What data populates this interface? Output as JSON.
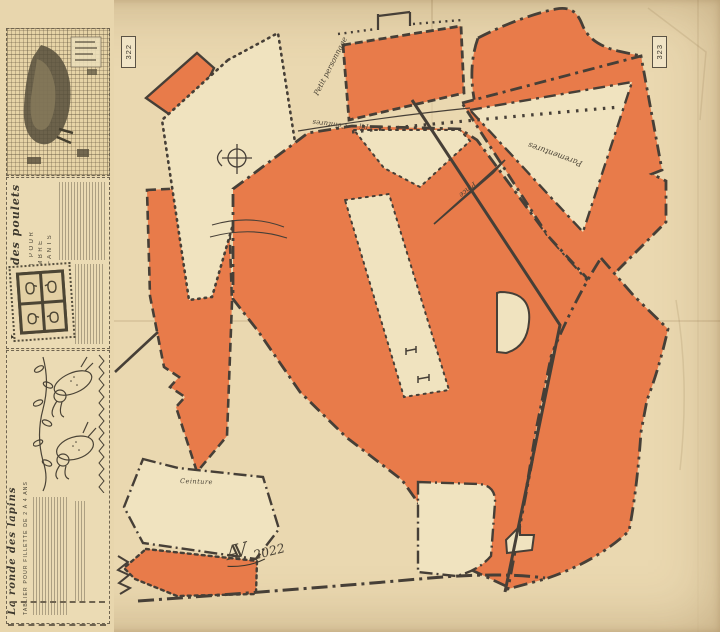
{
  "page": {
    "kind": "vintage sewing pattern sheet",
    "colors": {
      "paper": "#ead8b0",
      "piece_orange": "#e87b4a",
      "piece_cream": "#f0e3bf",
      "ink": "#463f37"
    }
  },
  "tags": {
    "left": "322",
    "right": "323"
  },
  "labels": {
    "petit_personnage": "Petit personnage",
    "ceintures": "Ceintures",
    "pli": "Pli",
    "pince": "Pince",
    "parementures": "Parementures",
    "ceinture": "Ceinture"
  },
  "signature": {
    "monogram": "AV",
    "year": "2022"
  },
  "sidebar": {
    "chicken_panel": {
      "title": "La parade des poulets",
      "subtitle_lines": [
        "COUSSIN POUR",
        "LA CHAMBRE",
        "DES ENFANTS"
      ]
    },
    "rabbit_panel": {
      "title": "La ronde des lapins",
      "subtitle": "TABLIER POUR FILLETTE DE 2 À 4 ANS"
    }
  }
}
